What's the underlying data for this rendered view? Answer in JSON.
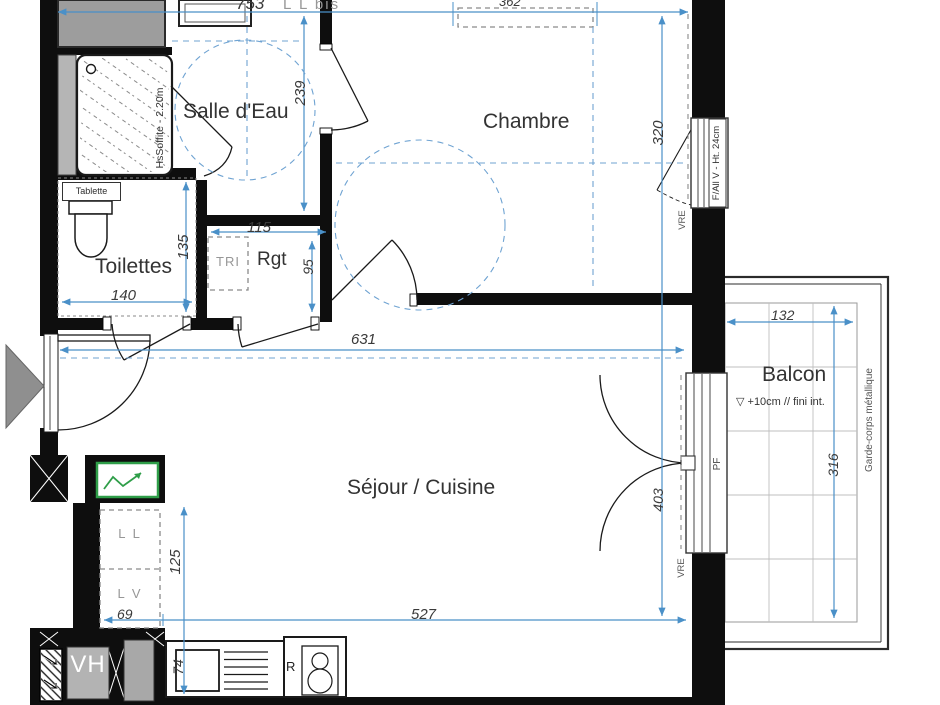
{
  "meta": {
    "type": "architectural-floor-plan",
    "units": "cm"
  },
  "colors": {
    "wall": "#0e0e0e",
    "dim_blue": "#4a90c8",
    "gray_fill": "#a6a6a6",
    "green_panel": "#2f9e49",
    "gray_text": "#979797"
  },
  "rooms": {
    "salle_deau": "Salle d'Eau",
    "chambre": "Chambre",
    "toilettes": "Toilettes",
    "rgt": "Rgt",
    "sejour_cuisine": "Séjour / Cuisine",
    "balcon": "Balcon"
  },
  "dimensions": {
    "d753": "753",
    "d362": "362",
    "d239": "239",
    "d320": "320",
    "d135": "135",
    "d140": "140",
    "d115": "115",
    "d95": "95",
    "d631": "631",
    "d132": "132",
    "d316": "316",
    "d403": "403",
    "d125": "125",
    "d69": "69",
    "d527": "527",
    "d74": "74"
  },
  "annotations": {
    "ll_bis": "L L bis",
    "hs_soffite": "HsSoffite - 2.20m",
    "tablette": "Tablette",
    "tri": "TRI",
    "f_all_v": "F/All V - Ht. 24cm",
    "vre_chambre": "VRE",
    "vre_balcon": "VRE",
    "pf": "PF",
    "balcon_note": "▽ +10cm // fini int.",
    "garde_corps": "Garde-corps métallique",
    "ll": "L L",
    "lv": "L V",
    "vh": "VH",
    "r": "R"
  }
}
